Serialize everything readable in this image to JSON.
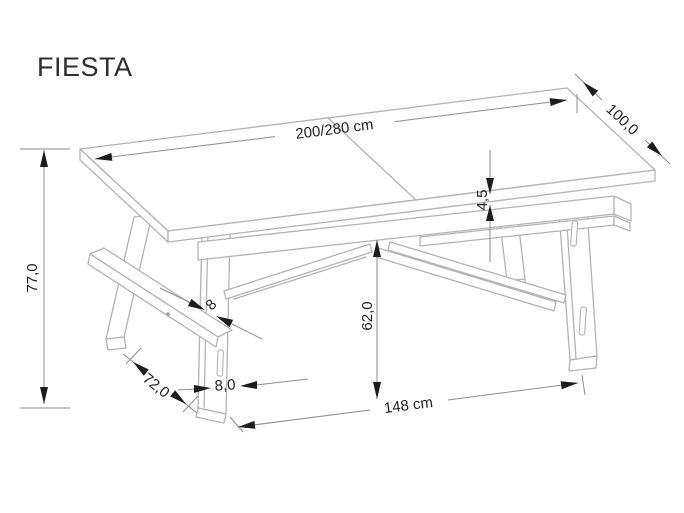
{
  "title": "FIESTA",
  "drawing": {
    "object": "extendable-dining-table-technical-drawing",
    "labels": {
      "length": "200/280 cm",
      "depth": "100,0",
      "height": "77,0",
      "top_thickness": "4,5",
      "clearance": "62,0",
      "base_length": "148 cm",
      "foot_spread": "72,0",
      "leg_width": "8,0",
      "brace_thickness": "8"
    },
    "colors": {
      "drawing_lines": "#b3b3b3",
      "dimension_lines": "#8c8c8c",
      "text_and_arrows": "#1c1c1c",
      "background": "#ffffff"
    }
  }
}
